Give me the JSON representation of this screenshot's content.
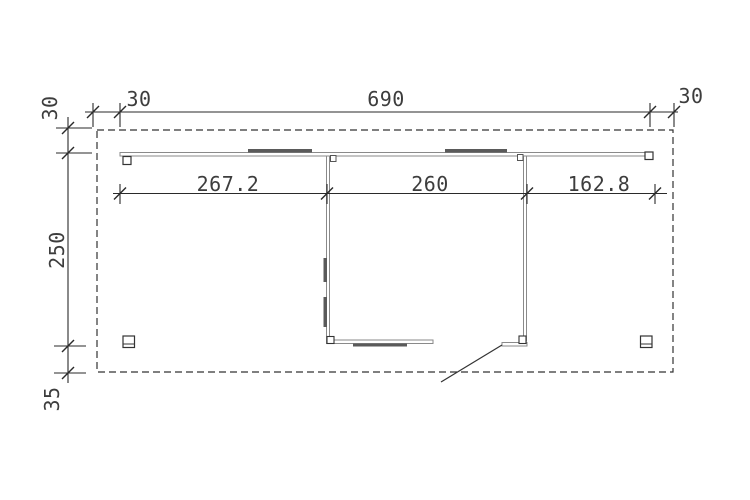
{
  "drawing": {
    "kind": "carport-floor-plan",
    "background_color": "#ffffff",
    "dimension_line_color": "#2a2a2a",
    "wall_line_color": "#8a8a8a",
    "panel_fill_color": "#5a5a5a",
    "text_color": "#3d3d3d",
    "dimensions": {
      "top_chain": {
        "left_overhang": "30",
        "total_width": "690",
        "right_overhang": "30"
      },
      "width_chain": {
        "left_bay": "267.2",
        "room_width": "260",
        "right_bay": "162.8"
      },
      "side_chain": {
        "top_overhang": "30",
        "depth": "250",
        "bottom_overhang": "35"
      }
    }
  }
}
